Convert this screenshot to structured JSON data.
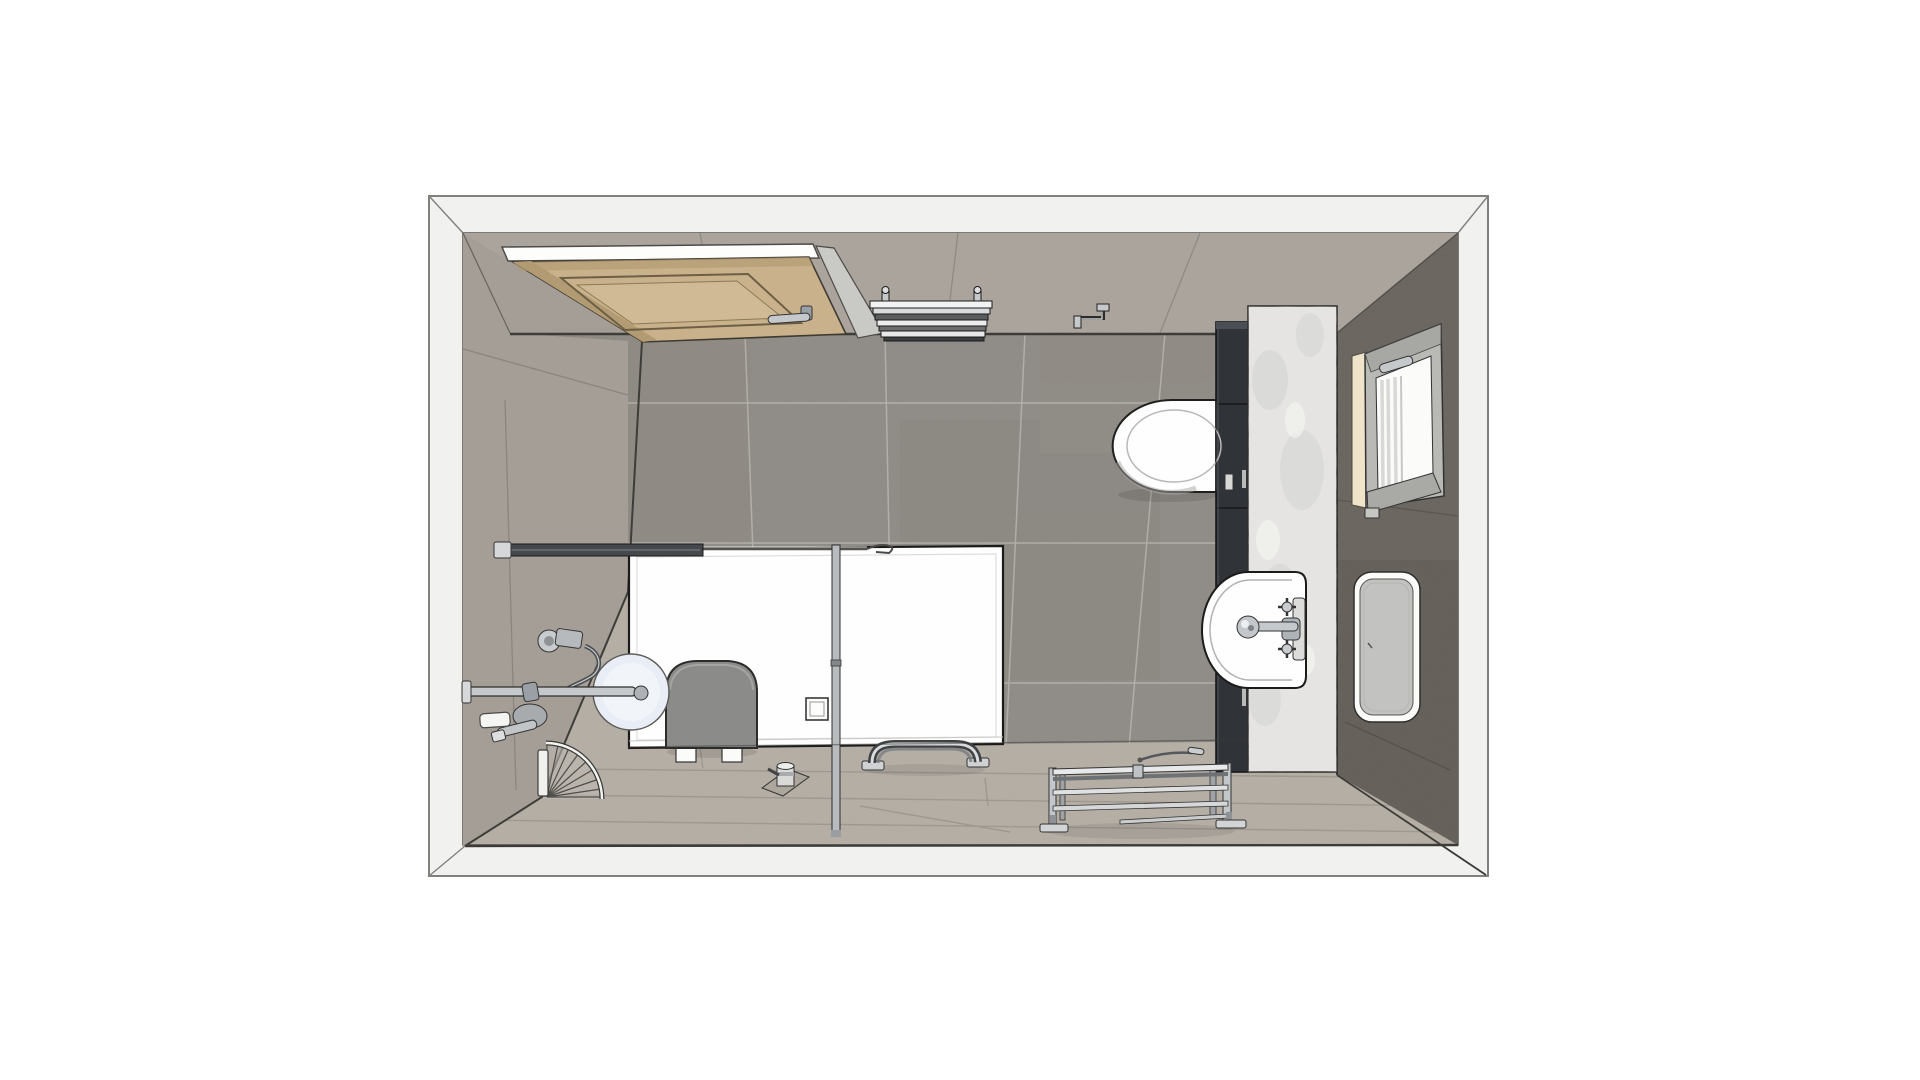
{
  "scene": {
    "kind": "3d-top-view-bathroom-floor-plan",
    "visible_text": "",
    "objects": [
      {
        "id": "room-shell",
        "label": "room walls top view"
      },
      {
        "id": "entry-door",
        "label": "wooden entry door (open, top wall)"
      },
      {
        "id": "towel-radiator",
        "label": "wall radiator / towel warmer"
      },
      {
        "id": "paper-holder",
        "label": "toilet paper holder"
      },
      {
        "id": "toilet",
        "label": "wall hung toilet"
      },
      {
        "id": "tall-cabinet",
        "label": "dark tall storage column"
      },
      {
        "id": "marble-column",
        "label": "marble vanity wall strip"
      },
      {
        "id": "window",
        "label": "window on right wall"
      },
      {
        "id": "mirror",
        "label": "mirror on right wall"
      },
      {
        "id": "washbasin",
        "label": "washbasin with mixer tap"
      },
      {
        "id": "shower",
        "label": "walk-in shower tray and glass screen"
      },
      {
        "id": "shower-seat",
        "label": "fold shower seat"
      },
      {
        "id": "shower-set",
        "label": "shower rail, hose, rain head"
      },
      {
        "id": "corner-basket",
        "label": "corner wire basket"
      },
      {
        "id": "floor-valve",
        "label": "floor drain valve"
      },
      {
        "id": "grab-bar",
        "label": "floor mounted grab bar"
      },
      {
        "id": "bench",
        "label": "chrome towel bench"
      },
      {
        "id": "squeegee",
        "label": "squeegee on floor"
      }
    ]
  },
  "colors": {
    "page_bg": "#ffffff",
    "frame_fill": "#f1f1ef",
    "frame_line": "#82807d",
    "inner_line": "#55534f",
    "wall_top": "#aaa49c",
    "wall_left": "#a49e96",
    "wall_right": "#6a655f",
    "wall_right_dark": "#5d5852",
    "floor_dark": "#8f8b86",
    "floor_light": "#b5aea5",
    "grout_light": "#cfcbc6",
    "outline_dark": "#3b3a36",
    "door_wood": "#c9b28b",
    "door_wood_shadow": "#b29a72",
    "door_frame_white": "#fdfdfc",
    "door_jamb": "#c9c9c6",
    "marble": "#e5e4e2",
    "marble_vein": "#d2d1cf",
    "cabinet": "#303338",
    "cabinet_edge": "#17181b",
    "cabinet_hl": "#4b4f55",
    "fixture_white": "#fefefe",
    "fixture_line": "#1f1f1d",
    "chrome": "#c6c9cc",
    "chrome_mid": "#9aa0a5",
    "chrome_dark": "#45484c",
    "seat_gray": "#8b8b8a",
    "shower_disc": "#e9edf5",
    "window_frame": "#b9b9b6",
    "window_sill": "#efe3ca",
    "glass_white": "#fbfbfa",
    "glass_stripe": "#d8d8d5",
    "mirror_face": "#c2c2c0",
    "radiator_dark": "#3c3e40"
  }
}
